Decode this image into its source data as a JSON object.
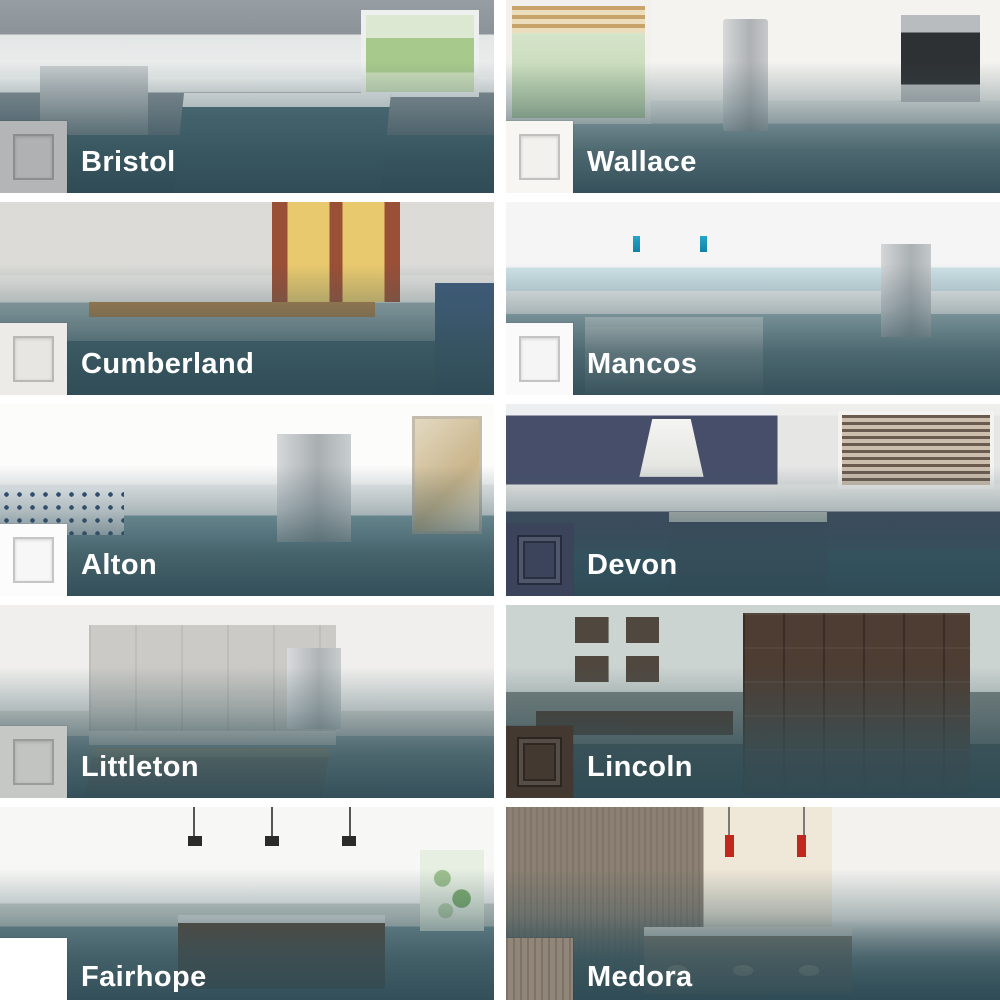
{
  "grid": {
    "rows": 5,
    "cols": 2
  },
  "overlay": {
    "color": "#38565e"
  },
  "label": {
    "color": "#ffffff"
  },
  "tiles": [
    {
      "name": "Bristol",
      "swatch_color": "#b3b5b7",
      "swatch_style": "shaker",
      "photo_alt": "Gray shaker kitchen with white marble island, stainless range and lawn window"
    },
    {
      "name": "Wallace",
      "swatch_color": "#f7f6f3",
      "swatch_style": "shaker",
      "photo_alt": "Bright white kitchen with blinds window, brass faucet, stainless fridge and wall oven"
    },
    {
      "name": "Cumberland",
      "swatch_color": "#edebe7",
      "swatch_style": "shaker",
      "photo_alt": "White kitchen with brick wall windows, wood bar top, sculpted stools and navy accents"
    },
    {
      "name": "Mancos",
      "swatch_color": "#fafafa",
      "swatch_style": "shaker",
      "photo_alt": "White kitchen with light blue backsplash, marble island, blue pendants and stainless fridge"
    },
    {
      "name": "Alton",
      "swatch_color": "#fcfcfc",
      "swatch_style": "shaker",
      "photo_alt": "White kitchen with blue patterned tile backsplash, copper pendants and framed art"
    },
    {
      "name": "Devon",
      "swatch_color": "#3c445c",
      "swatch_style": "raised",
      "photo_alt": "Navy blue kitchen with white hood, subway tile, blinds windows and window bench"
    },
    {
      "name": "Littleton",
      "swatch_color": "#c6c8c6",
      "swatch_style": "shaker",
      "photo_alt": "Light gray kitchen with glass pendants, stainless fridge and wood farmhouse table"
    },
    {
      "name": "Lincoln",
      "swatch_color": "#433931",
      "swatch_style": "raised",
      "photo_alt": "Dark brown home office with desk, gallery frames, floor lamp and leather chair"
    },
    {
      "name": "Fairhope",
      "swatch_color": "#ffffff",
      "swatch_style": "slab",
      "photo_alt": "Modern white flat-panel kitchen with dark wood island, black pendants and green art"
    },
    {
      "name": "Medora",
      "swatch_color": "#8b8073",
      "swatch_style": "wood",
      "photo_alt": "Gray-brown woodgrain kitchen with white brick backsplash, red pendants and cream stools"
    }
  ]
}
